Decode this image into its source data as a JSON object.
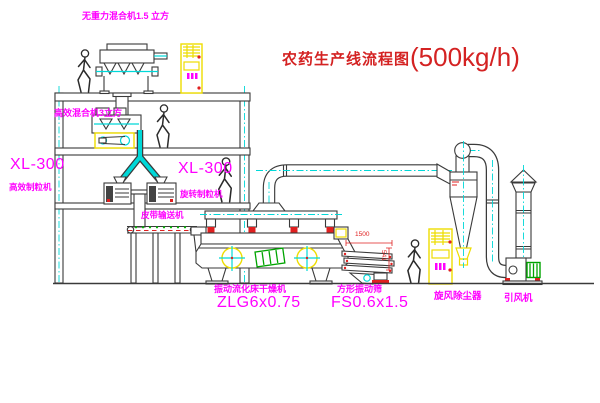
{
  "title": {
    "cn": "农药生产线流程图",
    "capacity": "(500kg/h)"
  },
  "labels": {
    "mixer_top": "无重力混合机1.5 立方",
    "mixer_2f": "高效混合机3立方",
    "xl300_left": {
      "model": "XL-300",
      "name": "高效制粒机"
    },
    "xl300_mid": {
      "model": "XL-300",
      "name": "旋转制粒机"
    },
    "conveyor": "皮带输送机",
    "dryer": {
      "name": "振动流化床干燥机",
      "model": "ZLG6x0.75"
    },
    "screen": {
      "name": "方形振动筛",
      "model": "FS0.6x1.5"
    },
    "cyclone": "旋风除尘器",
    "fan": "引风机"
  },
  "dimensions": {
    "screen_width": "1500",
    "screen_height": "541"
  },
  "colors": {
    "label_magenta": "#ff00ff",
    "title_red": "#d42222",
    "line": "#3a3a3a",
    "pipe_cyan": "#00d8d8",
    "cabinet_yellow": "#eedd00",
    "motor_green": "#00a400",
    "dim_red": "#e02020"
  }
}
